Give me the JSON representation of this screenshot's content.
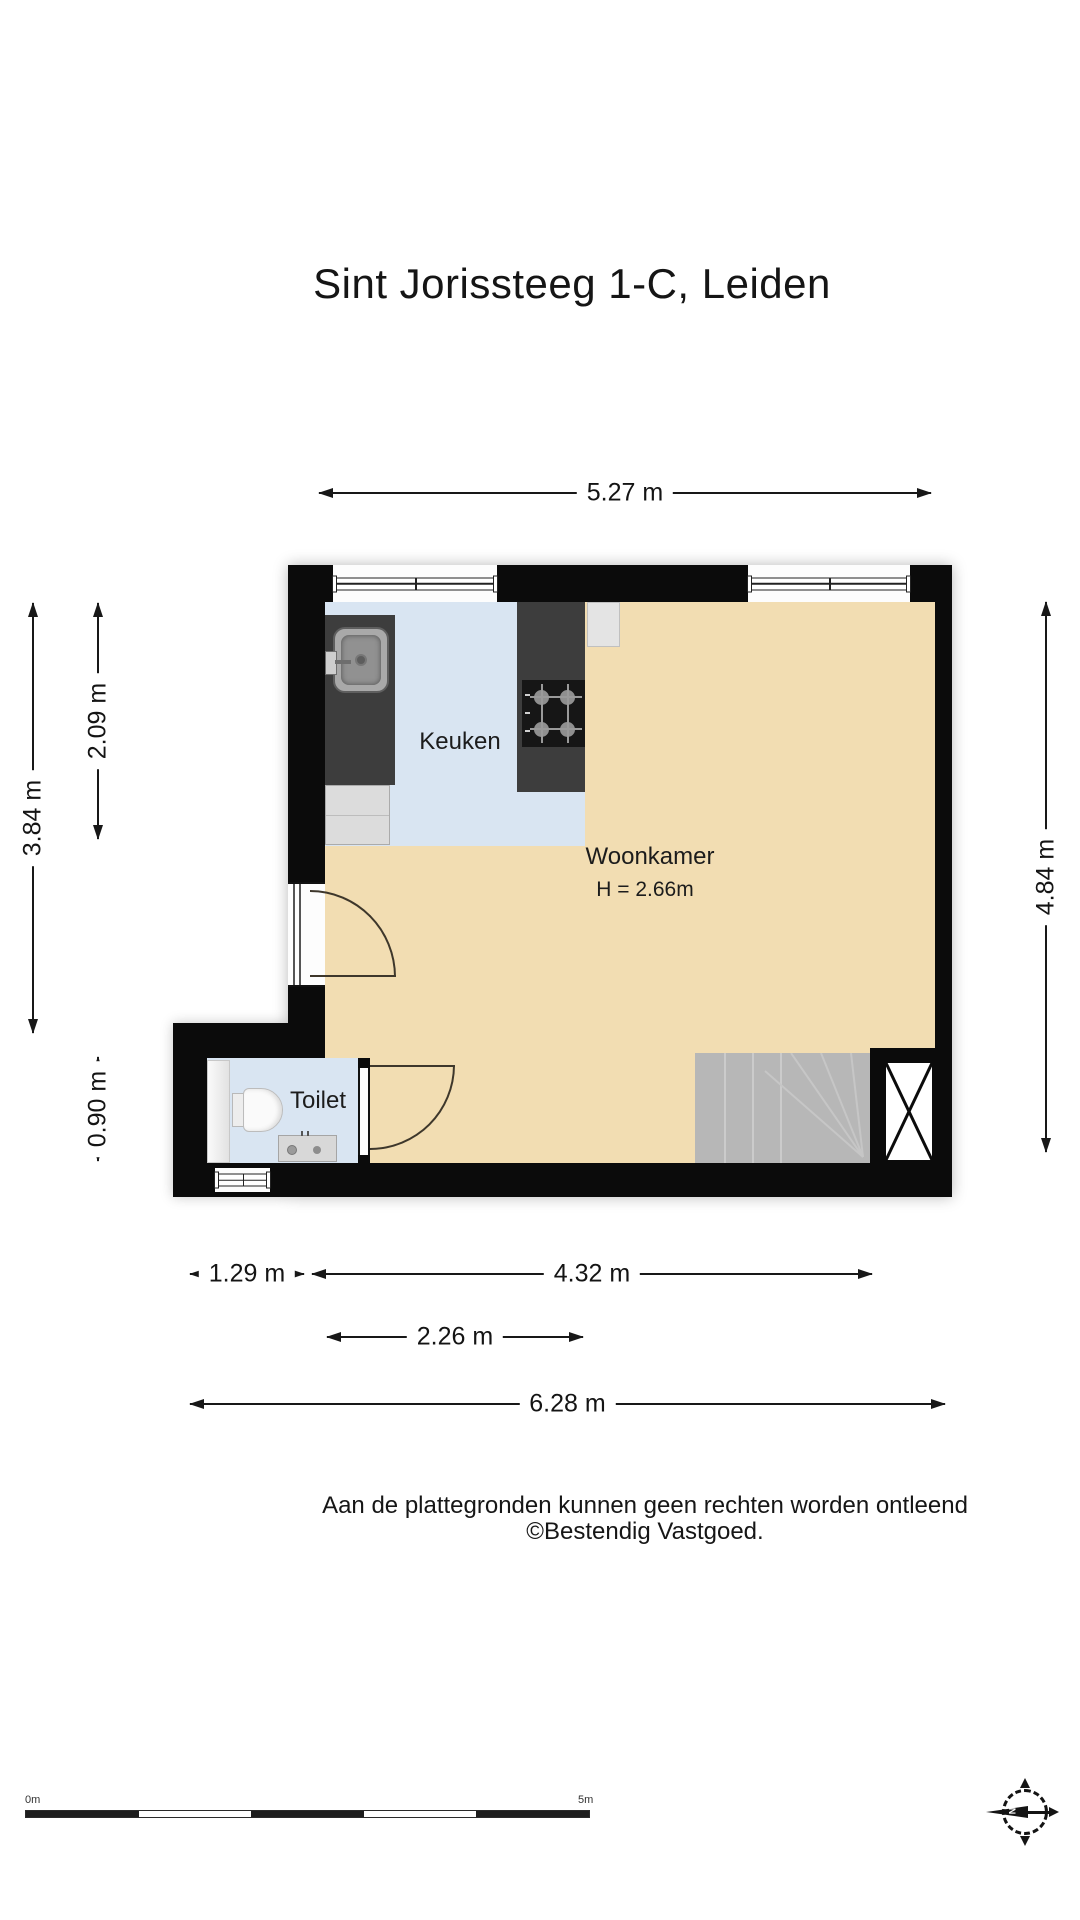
{
  "title": "Sint Jorissteeg 1-C, Leiden",
  "rooms": {
    "kitchen": {
      "label": "Keuken"
    },
    "living_room": {
      "label": "Woonkamer",
      "ceiling_height": "H = 2.66m"
    },
    "toilet": {
      "label": "Toilet"
    }
  },
  "dimensions": {
    "width_total_top": "5.27 m",
    "height_left_total": "3.84 m",
    "height_left_kitchen": "2.09 m",
    "height_left_toilet": "0.90 m",
    "height_right": "4.84 m",
    "width_toilet_section": "1.29 m",
    "width_living_section": "4.32 m",
    "width_kitchen": "2.26 m",
    "width_total_bottom": "6.28 m"
  },
  "footer": {
    "disclaimer_line1": "Aan de plattegronden kunnen geen rechten worden ontleend",
    "disclaimer_line2": "©Bestendig Vastgoed."
  },
  "scale_bar": {
    "start_label": "0m",
    "end_label": "5m"
  },
  "compass": {
    "north_label": "N"
  },
  "colors": {
    "wall": "#0b0b0b",
    "floor_living": "#f2ddb2",
    "floor_wet": "#d9e5f2",
    "counter": "#3d3d3d",
    "stairs": "#b7b7b7"
  }
}
